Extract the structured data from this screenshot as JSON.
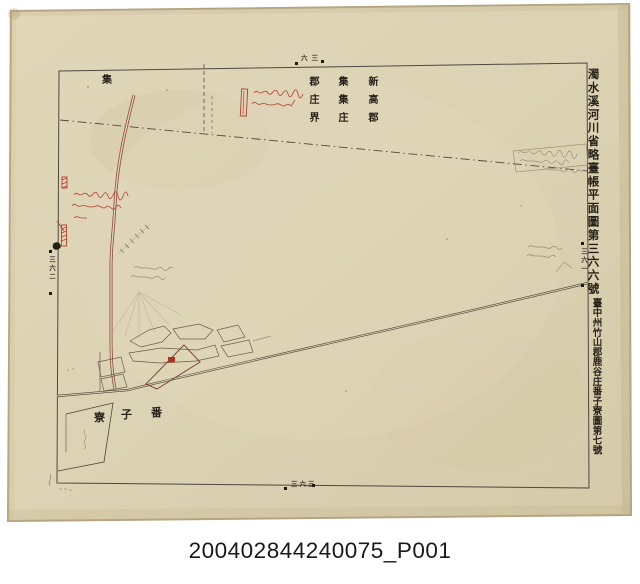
{
  "archive": {
    "caption": "200402844240075_P001"
  },
  "sheet": {
    "title_main": "濁水溪河川省略臺帳平面圖第三六六號",
    "title_sub": "臺中州竹山郡鹿谷庄番子寮圖第七號",
    "boundary_labels": [
      {
        "text": "新高郡"
      },
      {
        "text": "集集庄"
      },
      {
        "text": "郡庄界"
      }
    ],
    "corner_label": "集",
    "hamlet": {
      "name": "番子寮",
      "chars": [
        "寮",
        "子",
        "番"
      ]
    },
    "edge_marks": {
      "top": "六三",
      "bottom": "三六三",
      "left": "三六二",
      "right": "三六一"
    },
    "colors": {
      "paper": "#dcd2b4",
      "ink": "#272119",
      "vermilion": "#b5402e",
      "road_red": "#8f4c3b",
      "road_dark": "#4a3f33",
      "pencil": "#90846c"
    }
  }
}
